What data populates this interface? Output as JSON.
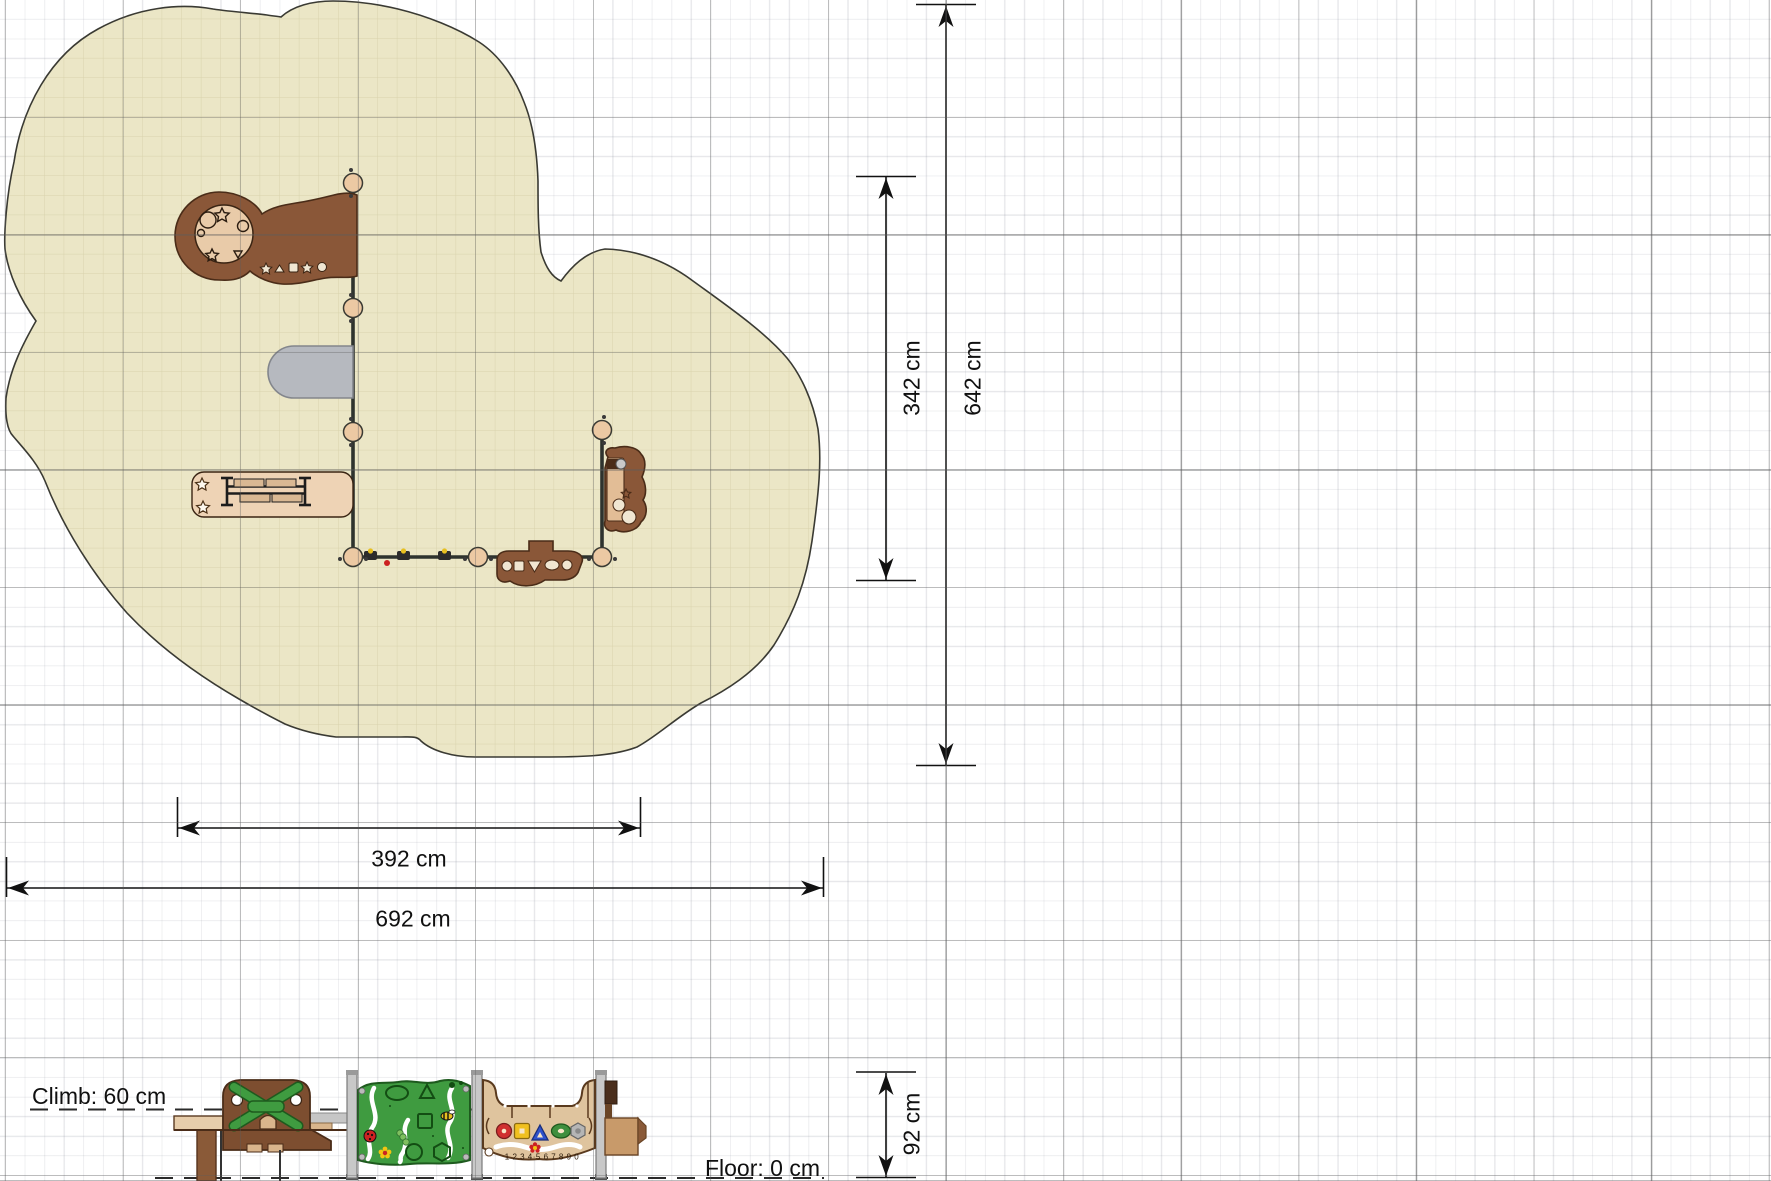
{
  "document": {
    "view": "playground safety-area plan with side elevation",
    "surface_shape": "cloud"
  },
  "plan_view": {
    "dimensions": {
      "inner_width": "392 cm",
      "total_width": "692 cm",
      "inner_height": "342 cm",
      "total_height": "642 cm"
    },
    "components": {
      "tower_platform": "round platform with play shapes",
      "slide": "slide (grey)",
      "bench_table": "table unit",
      "boat_panel": "boat play panel",
      "small_tower": "small side tower",
      "wall": "play wall with posts"
    }
  },
  "elevation_view": {
    "climb_height_label": "Climb: 60 cm",
    "floor_level_label": "Floor: 0 cm",
    "structure_height": "92 cm",
    "counting_panel_numbers": "1 2 3 4·5 6 7 8 9 0"
  },
  "colors": {
    "surfacing_fill": "#ebe6c6",
    "surfacing_grid": "#d8d2ac",
    "equipment_brown": "#8a5738",
    "equipment_outline": "#4a2c18",
    "platform_tan": "#e9cba9",
    "slide_gray": "#b6b9bf",
    "panel_green": "#3f9b40",
    "panel_tan": "#dfc49e",
    "steel_post": "#c8c8c8",
    "dimension_ink": "#111111"
  }
}
